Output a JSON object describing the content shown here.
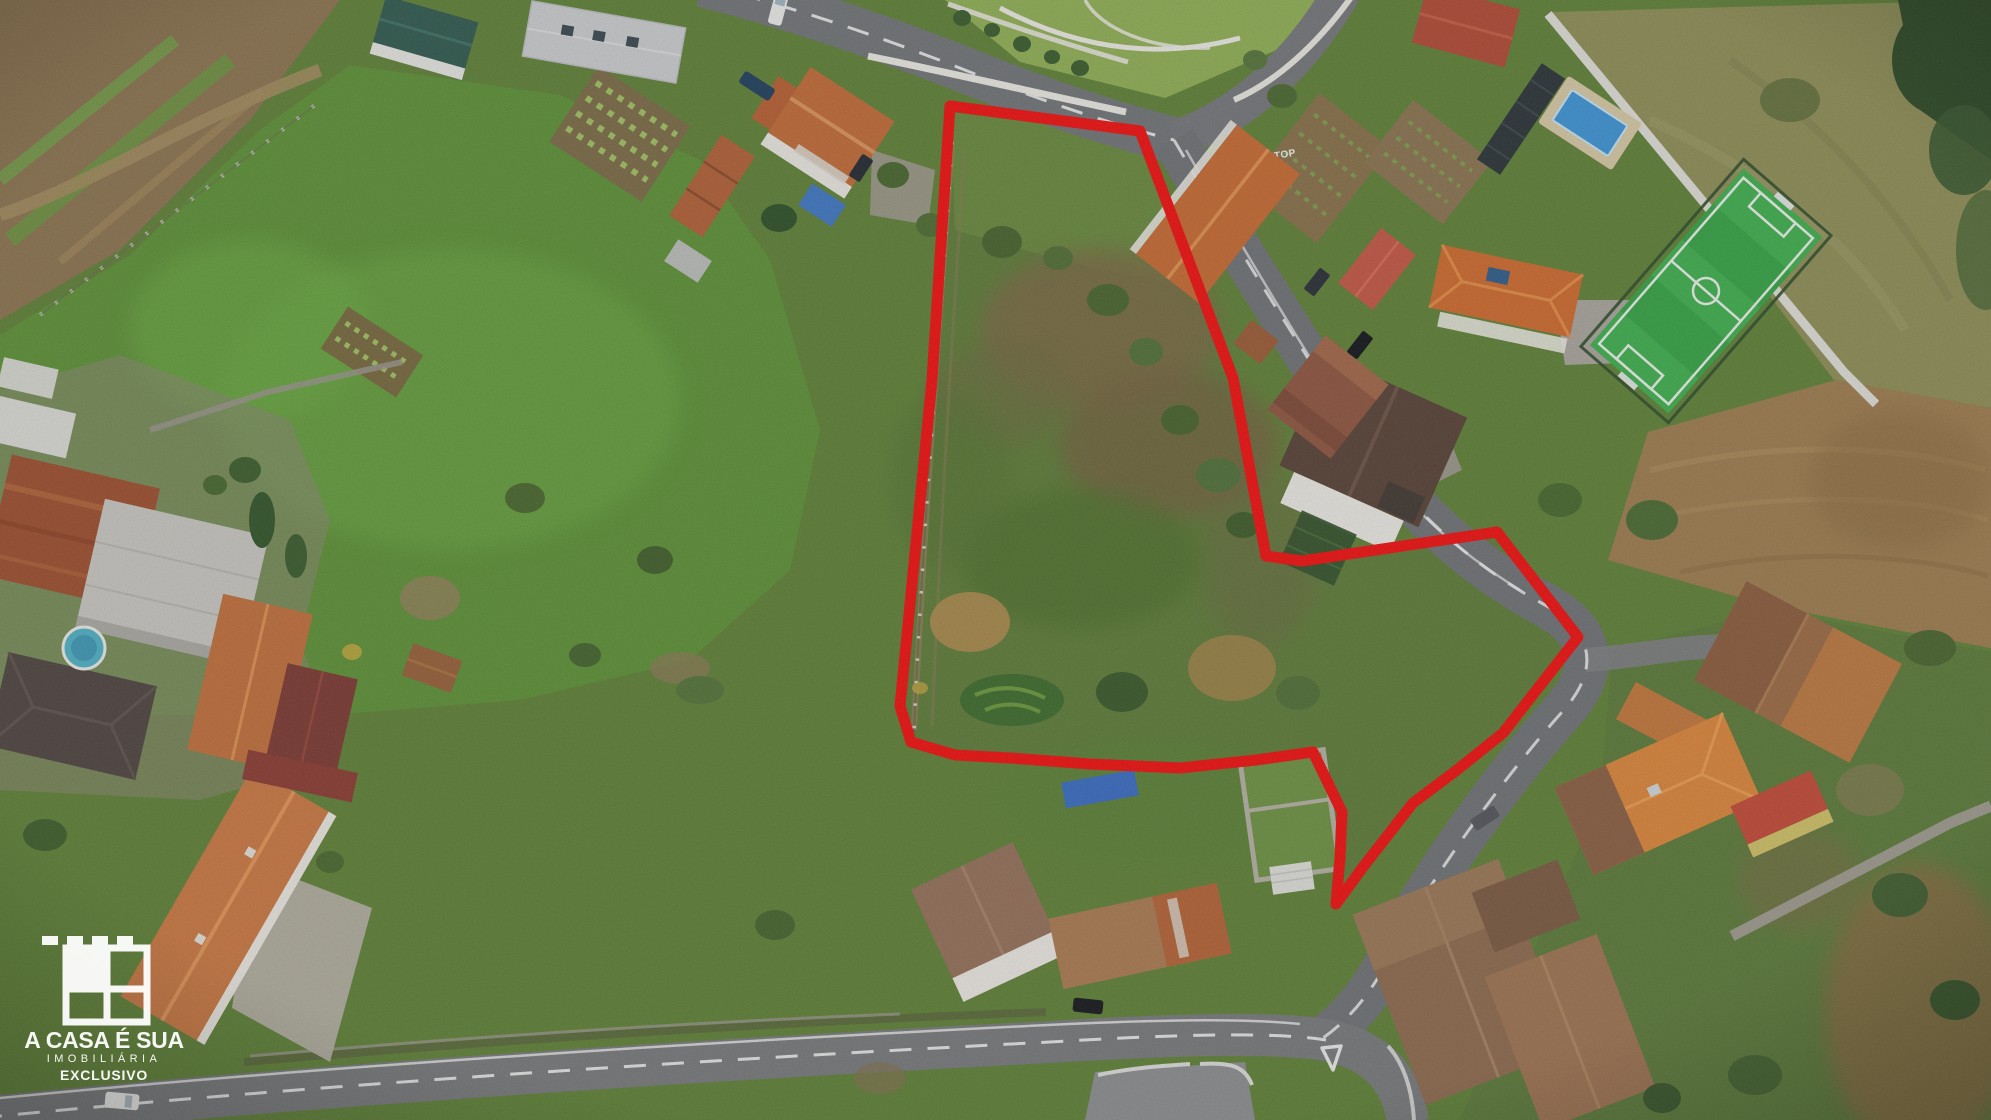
{
  "brand": {
    "title": "A CASA É SUA",
    "subtitle": "IMOBILIÁRIA",
    "badge": "EXCLUSIVO"
  },
  "road_markings": {
    "stop": "STOP"
  },
  "palette": {
    "boundary_red": "#ee1111",
    "meadow_green": "#5d9038",
    "parcel_green": "#5e7c3a",
    "scrub_brown": "#7b6844",
    "plowed_brown": "#9c7c50",
    "pasture_olive": "#8d8d57",
    "road_gray": "#717477",
    "turf_green": "#36a246",
    "pool_blue": "#3e93d4",
    "roof_orange": "#c06a38",
    "roof_red": "#b04a36",
    "roof_rust": "#9c4f30",
    "wall_white": "#e5e3de",
    "logo_white": "#ffffff"
  },
  "scene": {
    "type": "aerial drone photograph",
    "subject": "rural building plot outlined in red",
    "features": [
      "red property boundary",
      "village roads",
      "houses with tiled roofs",
      "fenced soccer pitch",
      "swimming pools",
      "green meadows",
      "plowed field",
      "real-estate watermark logo"
    ]
  }
}
